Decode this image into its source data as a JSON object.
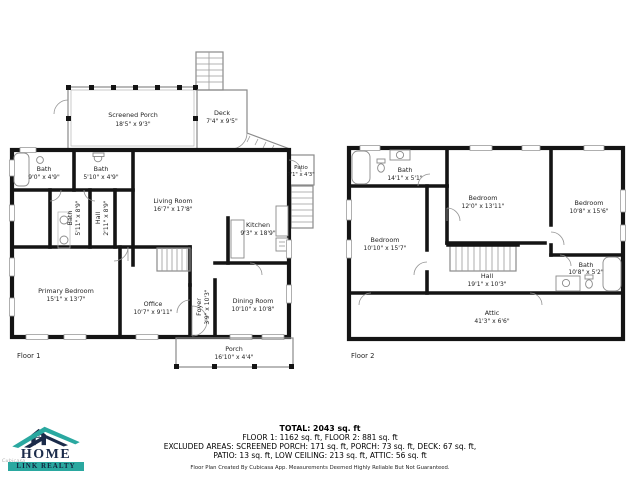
{
  "floor1": {
    "label": "Floor 1",
    "rooms": [
      {
        "name": "Screened Porch",
        "dims": "18'5\" x 9'3\""
      },
      {
        "name": "Deck",
        "dims": "7'4\" x 9'5\""
      },
      {
        "name": "Patio",
        "dims": "7'1\" x 4'3\""
      },
      {
        "name": "Bath",
        "dims": "9'0\" x 4'9\""
      },
      {
        "name": "Bath",
        "dims": "5'10\" x 4'9\""
      },
      {
        "name": "Bath",
        "dims": "5'11\" x 8'9\""
      },
      {
        "name": "Hall",
        "dims": "2'11\" x 8'9\""
      },
      {
        "name": "Living Room",
        "dims": "16'7\" x 17'8\""
      },
      {
        "name": "Kitchen",
        "dims": "9'3\" x 18'9\""
      },
      {
        "name": "Primary Bedroom",
        "dims": "15'1\" x 13'7\""
      },
      {
        "name": "Office",
        "dims": "10'7\" x 9'11\""
      },
      {
        "name": "Foyer",
        "dims": "3'9\" x 10'3\""
      },
      {
        "name": "Dining Room",
        "dims": "10'10\" x 10'8\""
      },
      {
        "name": "Porch",
        "dims": "16'10\" x 4'4\""
      }
    ]
  },
  "floor2": {
    "label": "Floor 2",
    "rooms": [
      {
        "name": "Bath",
        "dims": "14'1\" x 5'1\""
      },
      {
        "name": "Bedroom",
        "dims": "12'0\" x 13'11\""
      },
      {
        "name": "Bedroom",
        "dims": "10'8\" x 15'6\""
      },
      {
        "name": "Bedroom",
        "dims": "10'10\" x 15'7\""
      },
      {
        "name": "Hall",
        "dims": "19'1\" x 10'3\""
      },
      {
        "name": "Bath",
        "dims": "10'8\" x 5'2\""
      },
      {
        "name": "Attic",
        "dims": "41'3\" x 6'6\""
      }
    ]
  },
  "summary": {
    "total": "TOTAL: 2043 sq. ft",
    "floors": "FLOOR 1: 1162 sq. ft, FLOOR 2: 881 sq. ft",
    "excluded_line1": "EXCLUDED AREAS: SCREENED PORCH: 171 sq. ft, PORCH: 73 sq. ft, DECK: 67 sq. ft,",
    "excluded_line2": "PATIO: 13 sq. ft, LOW CEILING: 213 sq. ft, ATTIC: 56 sq. ft",
    "disclaimer": "Floor Plan Created By Cubicasa App. Measurements Deemed Highly Reliable But Not Guaranteed."
  },
  "logo": {
    "line1": "HOME",
    "line2": "LINK REALTY"
  },
  "watermark": "Cubicasa",
  "colors": {
    "teal": "#2aa8a0",
    "navy": "#1b2b4a",
    "wall": "#141414",
    "window": "#9c9c9c"
  }
}
